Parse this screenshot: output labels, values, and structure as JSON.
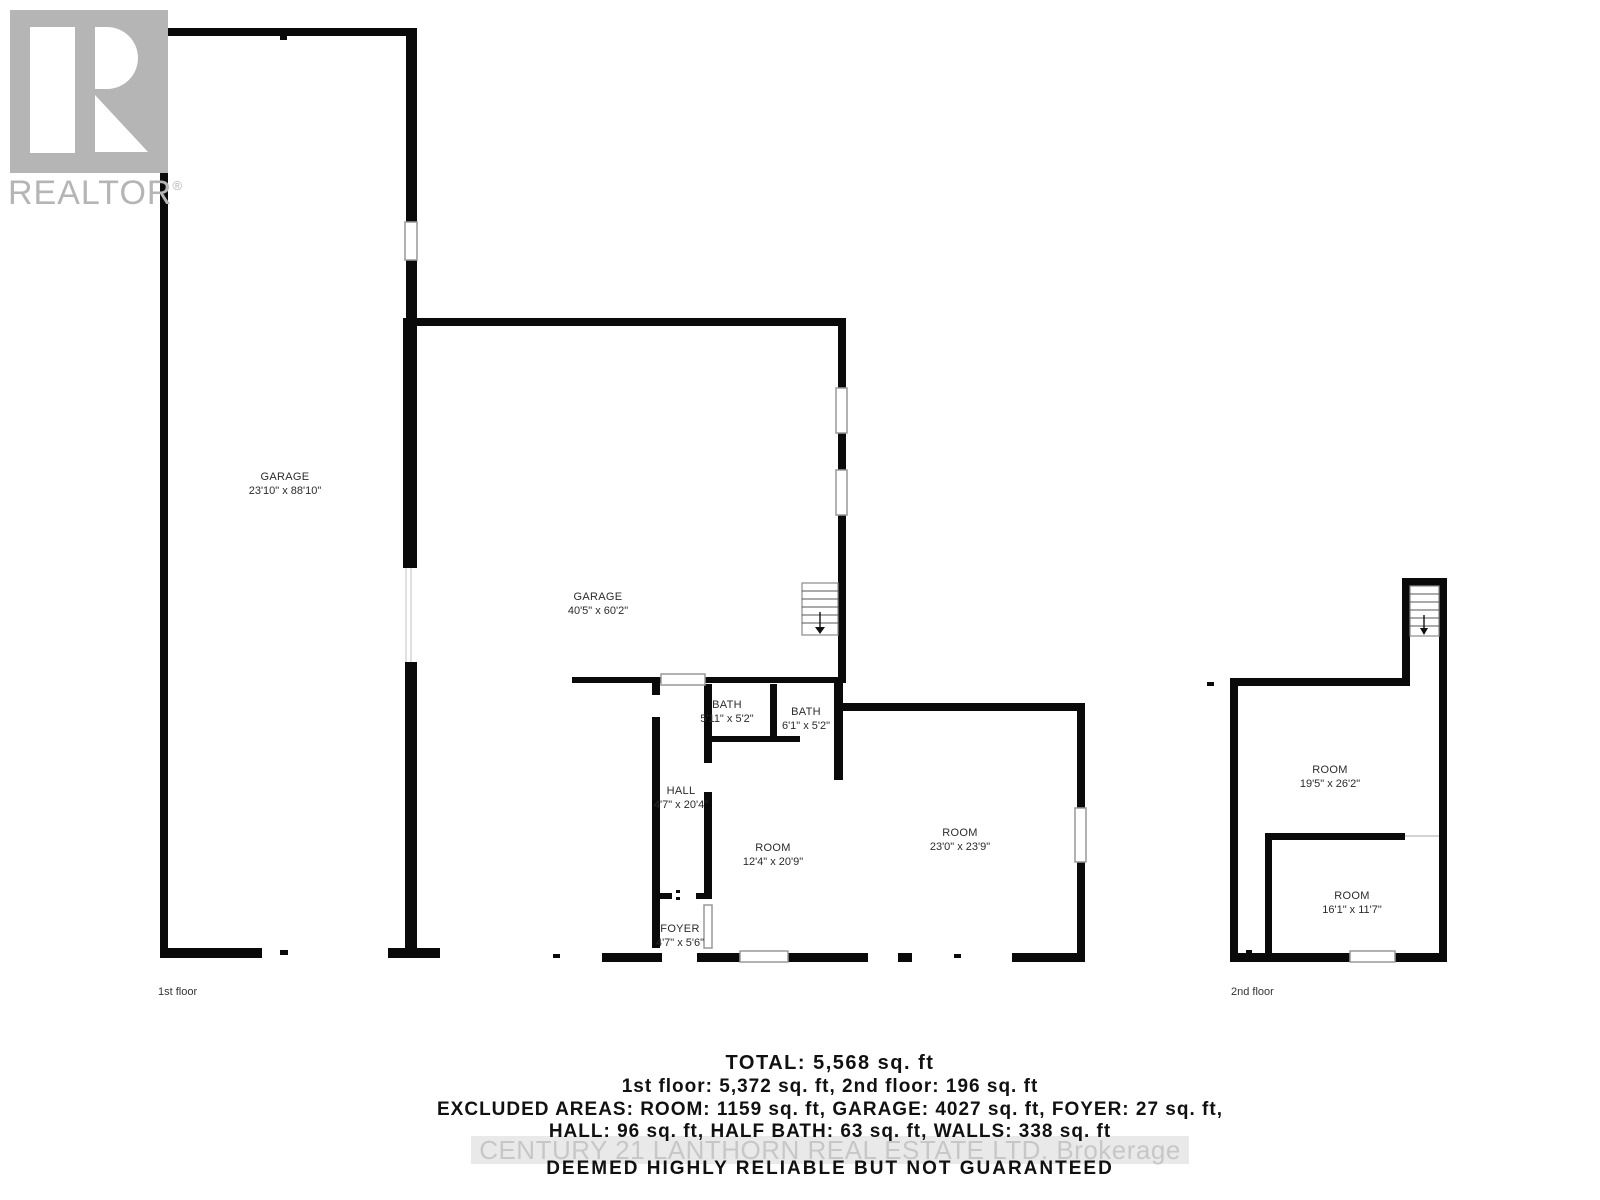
{
  "branding": {
    "logo_text": "REALTOR",
    "registered_mark": "®",
    "logo_color": "#b5b5b5"
  },
  "colors": {
    "wall": "#0a0a0a",
    "window_border": "#999999",
    "watermark_text": "#c7c7c7",
    "watermark_band": "#e9e9e9",
    "body_text": "#111111"
  },
  "floors": {
    "first": {
      "caption": "1st floor",
      "rooms": [
        {
          "name": "GARAGE",
          "dims": "23'10\" x 88'10\""
        },
        {
          "name": "GARAGE",
          "dims": "40'5\" x 60'2\""
        },
        {
          "name": "BATH",
          "dims": "5'11\" x 5'2\""
        },
        {
          "name": "BATH",
          "dims": "6'1\" x 5'2\""
        },
        {
          "name": "HALL",
          "dims": "4'7\" x 20'4\""
        },
        {
          "name": "ROOM",
          "dims": "12'4\" x 20'9\""
        },
        {
          "name": "ROOM",
          "dims": "23'0\" x 23'9\""
        },
        {
          "name": "FOYER",
          "dims": "4'7\" x 5'6\""
        }
      ]
    },
    "second": {
      "caption": "2nd floor",
      "rooms": [
        {
          "name": "ROOM",
          "dims": "19'5\" x 26'2\""
        },
        {
          "name": "ROOM",
          "dims": "16'1\" x 11'7\""
        }
      ]
    }
  },
  "summary": {
    "total": "TOTAL: 5,568 sq. ft",
    "floor_totals": "1st floor: 5,372 sq. ft, 2nd floor: 196 sq. ft",
    "excluded_line1": "EXCLUDED AREAS: ROOM: 1159 sq. ft, GARAGE: 4027 sq. ft, FOYER: 27 sq. ft,",
    "excluded_line2": "HALL: 96 sq. ft, HALF BATH: 63 sq. ft, WALLS: 338 sq. ft",
    "watermark": "CENTURY 21 LANTHORN REAL ESTATE LTD. Brokerage",
    "disclaimer": "DEEMED HIGHLY RELIABLE BUT NOT GUARANTEED"
  }
}
